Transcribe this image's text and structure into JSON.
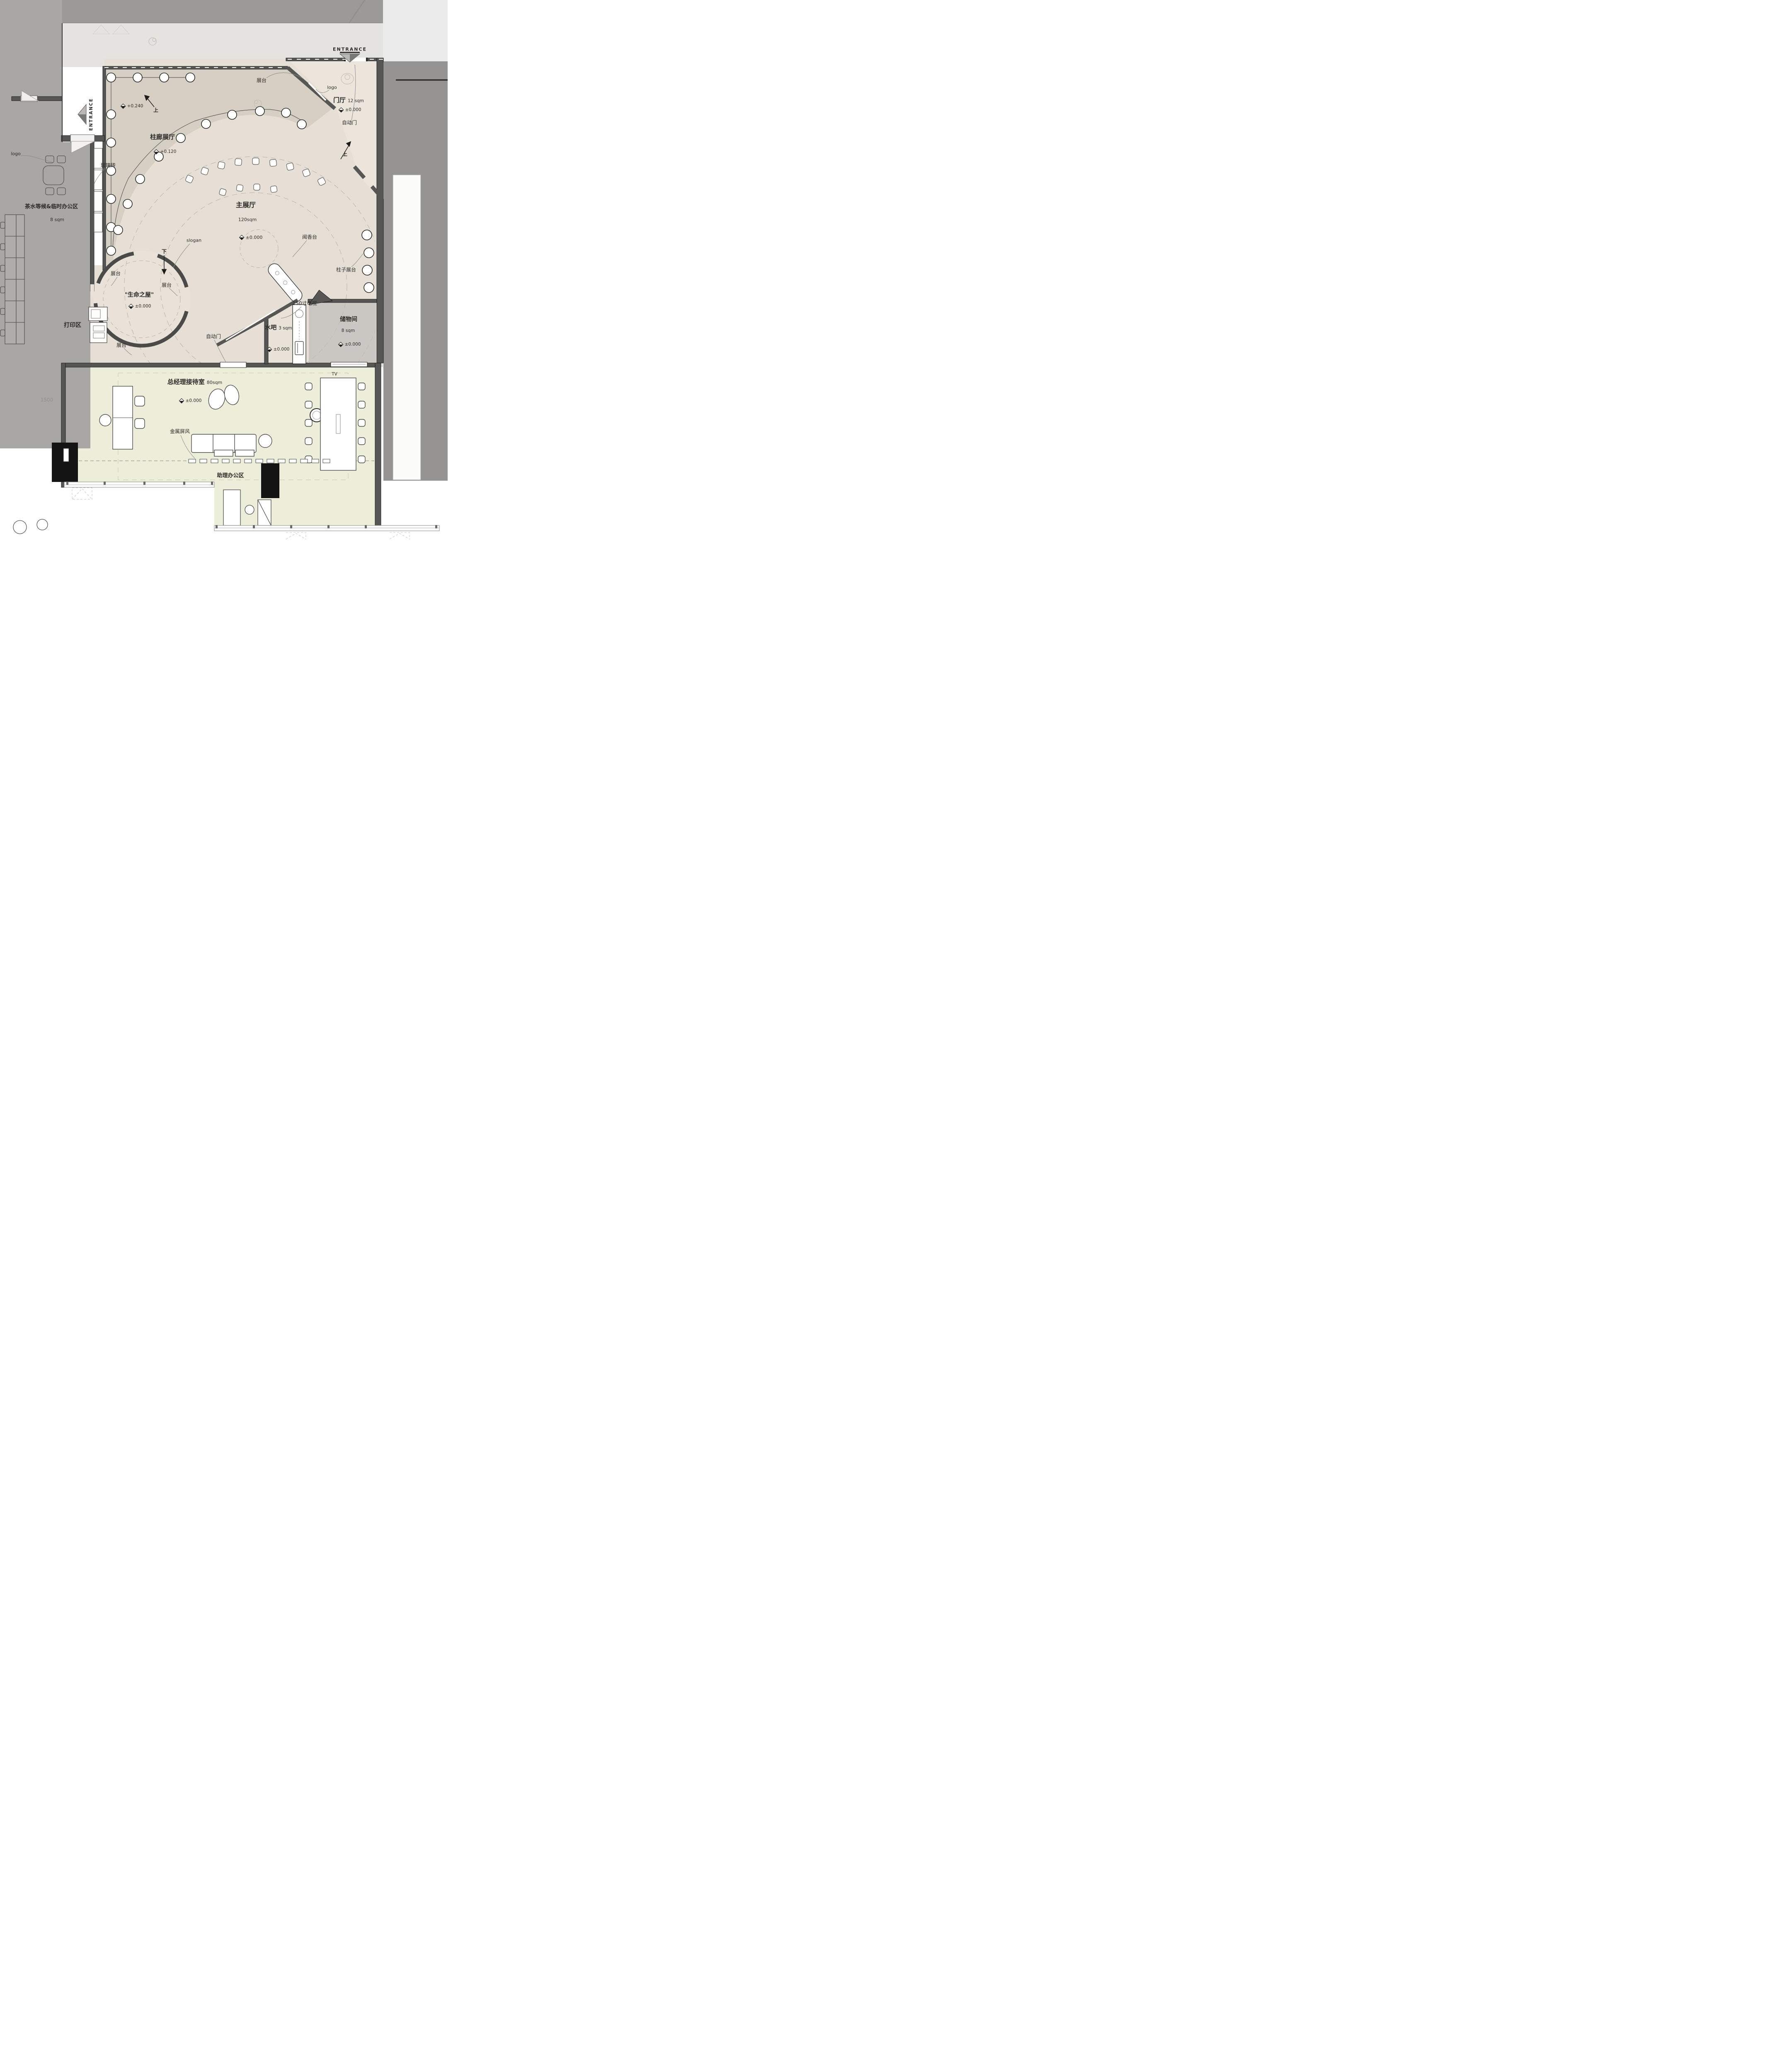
{
  "labels": {
    "entrance": "ENTRANCE",
    "logo": "logo",
    "display_stand": "展台",
    "up": "上",
    "down": "下",
    "auto_door": "自动门",
    "glass_brick": "玻璃砖",
    "slogan": "slogan",
    "fragrance_table": "闻香台",
    "column_display": "柱子展台",
    "tv_150": "150寸电视",
    "tv": "TV",
    "metal_screen": "金属屏风",
    "print_area": "打印区",
    "assistant_office": "助理办公区",
    "dim_1500": "1500"
  },
  "rooms": {
    "foyer": {
      "name": "门厅",
      "area": "12 sqm",
      "level": "±0.000"
    },
    "colonnade_hall": {
      "name": "柱廊展厅",
      "level": "+0.120",
      "upper_level": "+0.240"
    },
    "main_hall": {
      "name": "主展厅",
      "area": "120sqm",
      "level": "±0.000"
    },
    "life_house": {
      "name": "\"生命之屋\"",
      "level": "±0.000"
    },
    "tea_waiting": {
      "name": "茶水等候&临时办公区",
      "area": "8 sqm"
    },
    "water_bar": {
      "name": "水吧",
      "area": "3 sqm",
      "level": "±0.000"
    },
    "storage": {
      "name": "储物间",
      "area": "8 sqm",
      "level": "±0.000"
    },
    "gm_reception": {
      "name": "总经理接待室",
      "area": "80sqm",
      "level": "±0.000"
    }
  },
  "colors": {
    "exterior_band": "#9b9a97",
    "walkway": "#e4e3e0",
    "neighbor_gray": "#959492",
    "tea_area_gray": "#a8a7a4",
    "colonnade_tan": "#d6cfc4",
    "main_hall_beige": "#e6dfd5",
    "foyer_cream": "#ece5dc",
    "reception_green": "#edeeda",
    "storage_gray": "#cac7c3",
    "wall": "#565654"
  }
}
